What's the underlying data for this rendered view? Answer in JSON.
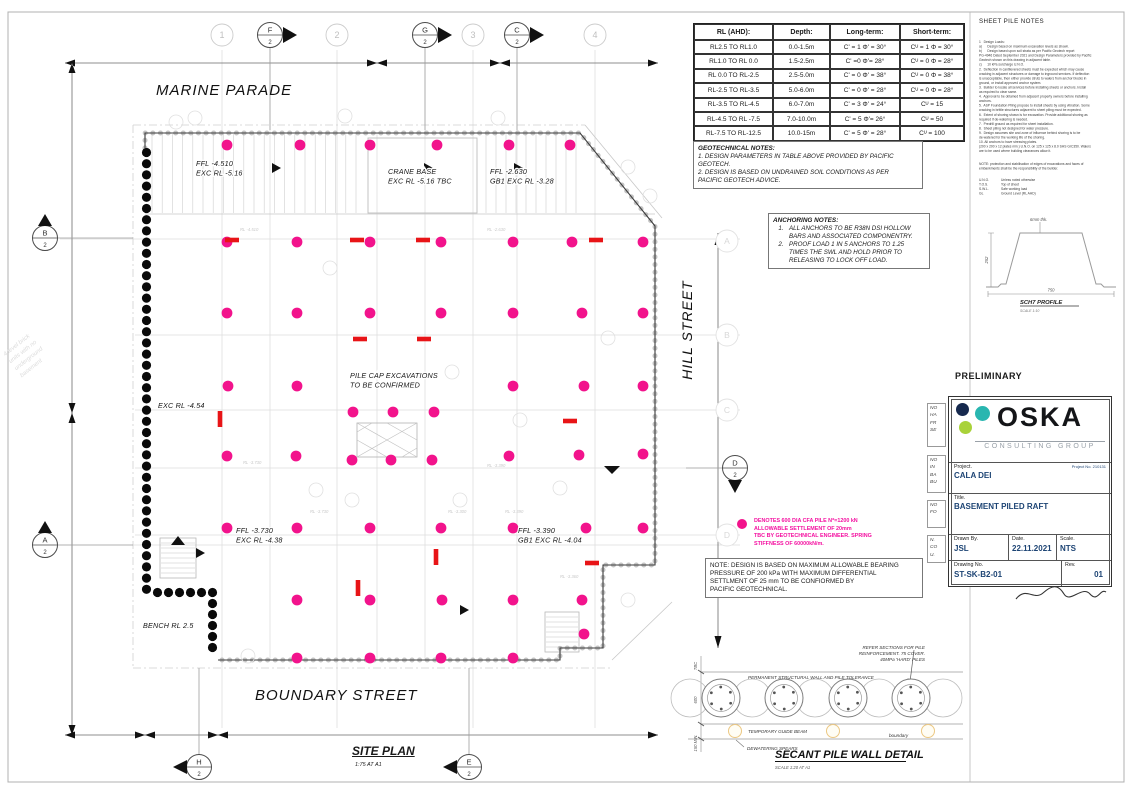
{
  "preliminary": "PRELIMINARY",
  "soil_table": {
    "headers": [
      "RL (AHD):",
      "Depth:",
      "Long-term:",
      "Short-term:"
    ],
    "rows": [
      [
        "RL2.5 TO RL1.0",
        "0.0-1.5m",
        "C' = 1 Φ' = 30°",
        "Cᵁ = 1 Φ = 30°"
      ],
      [
        "RL1.0 TO RL 0.0",
        "1.5-2.5m",
        "C' =0 Φ'= 28°",
        "Cᵁ = 0 Φ = 28°"
      ],
      [
        "RL 0.0 TO RL-2.5",
        "2.5-5.0m",
        "C' = 0 Φ' = 38°",
        "Cᵁ = 0 Φ = 38°"
      ],
      [
        "RL-2.5 TO RL-3.5",
        "5.0-6.0m",
        "C' = 0 Φ' = 28°",
        "Cᵁ = 0 Φ = 28°"
      ],
      [
        "RL-3.5 TO RL-4.5",
        "6.0-7.0m",
        "C' = 3 Φ' = 24°",
        "Cᵁ = 15"
      ],
      [
        "RL-4.5 TO RL -7.5",
        "7.0-10.0m",
        "C' = 5 Φ'= 26°",
        "Cᵁ = 50"
      ],
      [
        "RL-7.5 TO RL-12.5",
        "10.0-15m",
        "C' = 5 Φ' = 28°",
        "Cᵁ = 100"
      ]
    ]
  },
  "geotech_notes": {
    "title": "GEOTECHNICAL NOTES:",
    "lines": [
      "1. DESIGN PARAMETERS IN TABLE ABOVE PROVIDED BY PACIFIC",
      "GEOTECH.",
      "2. DESIGN IS BASED ON UNDRAINED SOIL CONDITIONS AS PER",
      "PACIFIC GEOTECH ADVICE."
    ]
  },
  "anchoring_notes": {
    "title": "ANCHORING NOTES:",
    "items": [
      {
        "num": "1.",
        "lines": [
          "ALL ANCHORS TO BE R38N DSI HOLLOW",
          "BARS AND ASSOCIATED COMPONENTRY."
        ]
      },
      {
        "num": "2.",
        "lines": [
          "PROOF LOAD 1 IN 5 ANCHORS TO 1.25",
          "TIMES THE SWL AND HOLD PRIOR TO",
          "RELEASING TO LOCK OFF LOAD."
        ]
      }
    ]
  },
  "sheet_pile_notes": {
    "title": "SHEET PILE NOTES",
    "lines": [
      "1   Design Loads:",
      "a)      Design based on maximum excavation levels as shown.",
      "b)      Design based upon soil strata as per Pacific Geotech report",
      "PG-4946 Dated September 2021 and Design Parameters provided by Pacific",
      "Geotech shown on this drawing in adjacent table.",
      "c)      10 kPa surcharge U.N.O.",
      "2.  Deflection in cantilevered sheets must be expected which may cause",
      "cracking in adjacent structures or damage to inground services. If deflection",
      "is unacceptable, then either provide struts to walers from anchor blocks in",
      "ground, or install approved anchor system.",
      "3.  Builder to locate all services before installing sheets or anchors. Install",
      "as required to clear same.",
      "4.  Approval to be obtained from adjacent property owners before installing",
      "anchors.",
      "5.  ASP Foundation Piling propose to install sheets by using vibration. Some",
      "cracking in brittle structures adjacent to sheet piling must be expected.",
      "6.  Extent of shoring shown is for excavation. Provide additional shoring as",
      "required if de-watering is needed.",
      "7.  Predrill ground as required for sheet installation.",
      "8.  Sheet piling not designed for water pressure.",
      "9.  Design assumes site and zone of influence behind shoring is to be",
      "de-watered for the working life of the shoring.",
      "10. All anchors to have stressing plates.",
      "(200 x 200 x 12 plates min.) U.N.O. on 125 x 125 x 8.0 SHS GrC350. Walers",
      "are to be used where building clearances allow it."
    ],
    "note_lines": [
      "NOTE: protection and stabilisation of edges of excavations and faces of",
      "embankments shall be the responsibility of the builder."
    ],
    "abbrevs": [
      [
        "U.N.O.",
        "Unless noted otherwise"
      ],
      [
        "T.O.S.",
        "Top of sheet"
      ],
      [
        "S.W.L.",
        "Safe working load"
      ],
      [
        "GL",
        "Ground Level (RL AHD)"
      ]
    ]
  },
  "sch7": {
    "thickness": "6mm thk.",
    "height_dim": "252",
    "width_dim": "750",
    "title": "SCH7 PROFILE",
    "subtitle": "SCALE 1:10"
  },
  "pink_legend": {
    "color": "#F2138C",
    "lines": [
      "DENOTES 600 DIA CFA PILE N*=1200 kN",
      "ALLOWABLE SETTLEMENT OF 20mm",
      "TBC BY GEOTECHNICAL ENGINEER. SPRING",
      "STIFFNESS OF 60000kN/m."
    ]
  },
  "bearing_note": [
    "NOTE: DESIGN IS BASED ON MAXIMUM ALLOWABLE BEARING",
    "PRESSURE OF 200 kPa WITH MAXIMUM DIFFERENTIAL",
    "SETTLMENT OF 25 mm TO BE CONFIORMED BY",
    "PACIFIC GEOTECHNICAL."
  ],
  "title_block": {
    "project_no": "Project No. 210131",
    "logo": {
      "word": "OSKA",
      "sub": "CONSULTING GROUP",
      "dot_colors": [
        "#16294E",
        "#29B6B0",
        "#A9D23A"
      ]
    },
    "project_label": "Project.",
    "project": "CALA DEI",
    "title_label": "Title.",
    "title": "BASEMENT PILED RAFT",
    "drawn_label": "Drawn By.",
    "drawn": "JSL",
    "date_label": "Date.",
    "date": "22.11.2021",
    "scale_label": "Scale.",
    "scale": "NTS",
    "dwg_label": "Drawing No.",
    "dwg": "ST-SK-B2-01",
    "rev_label": "Rev.",
    "rev": "01"
  },
  "clipped_notes": [
    [
      "NO",
      "HA",
      "FR",
      "SE"
    ],
    [
      "NO",
      "IN",
      "BA",
      "BU"
    ],
    [
      "NO",
      "FO"
    ],
    [
      "N.",
      "CO",
      "U."
    ]
  ],
  "plan": {
    "street_top": "MARINE PARADE",
    "street_right": "HILL STREET",
    "street_bottom": "BOUNDARY STREET",
    "site_title": "SITE PLAN",
    "site_scale": "1:75 AT A1",
    "ghost_lines": [
      "4 level brick",
      "units with no",
      "underground",
      "basement"
    ],
    "labels": [
      {
        "x": 196,
        "y": 166,
        "lines": [
          "FFL -4.510",
          "EXC RL -5.16"
        ]
      },
      {
        "x": 388,
        "y": 174,
        "lines": [
          "CRANE BASE",
          "EXC RL -5.16 TBC"
        ]
      },
      {
        "x": 490,
        "y": 174,
        "lines": [
          "FFL -2.630",
          "GB1 EXC RL -3.28"
        ]
      },
      {
        "x": 350,
        "y": 378,
        "lines": [
          "PILE CAP EXCAVATIONS",
          "TO BE CONFIRMED"
        ]
      },
      {
        "x": 158,
        "y": 408,
        "lines": [
          "EXC RL -4.54"
        ]
      },
      {
        "x": 236,
        "y": 533,
        "lines": [
          "FFL -3.730",
          "EXC RL -4.38"
        ]
      },
      {
        "x": 518,
        "y": 533,
        "lines": [
          "FFL -3.390",
          "GB1 EXC RL -4.04"
        ]
      },
      {
        "x": 143,
        "y": 628,
        "lines": [
          "BENCH RL 2.5"
        ]
      }
    ],
    "faint_labels": [
      {
        "x": 240,
        "y": 231,
        "t": "RL -4.510"
      },
      {
        "x": 487,
        "y": 231,
        "t": "RL -2.630"
      },
      {
        "x": 243,
        "y": 464,
        "t": "RL -3.730"
      },
      {
        "x": 310,
        "y": 513,
        "t": "RL -3.730"
      },
      {
        "x": 487,
        "y": 467,
        "t": "RL -3.390"
      },
      {
        "x": 505,
        "y": 513,
        "t": "RL -3.390"
      },
      {
        "x": 448,
        "y": 513,
        "t": "RL -3.300"
      },
      {
        "x": 560,
        "y": 578,
        "t": "RL -3.360"
      }
    ],
    "grid": {
      "top": [
        {
          "label": "1",
          "x": 222,
          "type": "grid"
        },
        {
          "label": "F",
          "sub": "2",
          "x": 270,
          "type": "section"
        },
        {
          "label": "2",
          "x": 337,
          "type": "grid"
        },
        {
          "label": "G",
          "sub": "2",
          "x": 425,
          "type": "section"
        },
        {
          "label": "3",
          "x": 473,
          "type": "grid"
        },
        {
          "label": "C",
          "sub": "2",
          "x": 517,
          "type": "section"
        },
        {
          "label": "4",
          "x": 595,
          "type": "grid"
        }
      ],
      "left": [
        {
          "label": "B",
          "sub": "2",
          "y": 238
        },
        {
          "label": "A",
          "sub": "2",
          "y": 545
        }
      ],
      "right": [
        {
          "label": "A",
          "y": 241,
          "type": "faint"
        },
        {
          "label": "B",
          "y": 335,
          "type": "faint"
        },
        {
          "label": "C",
          "y": 410,
          "type": "faint"
        },
        {
          "label": "D",
          "sub": "2",
          "y": 468,
          "type": "section"
        },
        {
          "label": "D",
          "y": 535,
          "type": "faint"
        }
      ],
      "bottom": [
        {
          "label": "H",
          "sub": "2",
          "x": 199
        },
        {
          "label": "E",
          "sub": "2",
          "x": 469
        }
      ]
    }
  },
  "piles": {
    "color": "#F2138C",
    "points": [
      [
        227,
        145
      ],
      [
        300,
        145
      ],
      [
        370,
        145
      ],
      [
        437,
        145
      ],
      [
        509,
        145
      ],
      [
        570,
        145
      ],
      [
        227,
        242
      ],
      [
        297,
        242
      ],
      [
        370,
        242
      ],
      [
        441,
        242
      ],
      [
        513,
        242
      ],
      [
        572,
        242
      ],
      [
        643,
        242
      ],
      [
        227,
        313
      ],
      [
        297,
        313
      ],
      [
        370,
        313
      ],
      [
        441,
        313
      ],
      [
        513,
        313
      ],
      [
        582,
        313
      ],
      [
        643,
        313
      ],
      [
        228,
        386
      ],
      [
        297,
        386
      ],
      [
        513,
        386
      ],
      [
        584,
        386
      ],
      [
        643,
        386
      ],
      [
        353,
        412
      ],
      [
        393,
        412
      ],
      [
        434,
        412
      ],
      [
        227,
        456
      ],
      [
        296,
        456
      ],
      [
        352,
        460
      ],
      [
        391,
        460
      ],
      [
        432,
        460
      ],
      [
        509,
        456
      ],
      [
        579,
        455
      ],
      [
        643,
        454
      ],
      [
        227,
        528
      ],
      [
        297,
        528
      ],
      [
        370,
        528
      ],
      [
        441,
        528
      ],
      [
        513,
        528
      ],
      [
        586,
        528
      ],
      [
        643,
        528
      ],
      [
        297,
        600
      ],
      [
        370,
        600
      ],
      [
        442,
        600
      ],
      [
        513,
        600
      ],
      [
        582,
        600
      ],
      [
        584,
        634
      ],
      [
        297,
        658
      ],
      [
        370,
        658
      ],
      [
        441,
        658
      ],
      [
        513,
        658
      ]
    ]
  },
  "anchors": {
    "color": "#E81417",
    "h": [
      [
        232,
        240
      ],
      [
        357,
        240
      ],
      [
        423,
        240
      ],
      [
        596,
        240
      ],
      [
        360,
        339
      ],
      [
        424,
        339
      ],
      [
        570,
        421
      ],
      [
        592,
        563
      ]
    ],
    "v": [
      [
        220,
        419
      ],
      [
        436,
        557
      ],
      [
        358,
        588
      ]
    ]
  },
  "secant_detail": {
    "refer_lines": [
      "REFER SECTIONS FOR PILE",
      "REINFORCEMENT. 75 COVER.",
      "40MPa 'HARD' PILES"
    ],
    "perm": "PERMANENT STRUCTURAL WALL AND PILE TOLERANCE",
    "guide": "TEMPORARY GUIDE BEAM",
    "boundary": "boundary",
    "spears": "DEWATERING SPEARS",
    "title": "SECANT PILE WALL DETAIL",
    "scale": "SCALE 1:20 AT A1",
    "dims": [
      "TBC",
      "600",
      "150 MIN."
    ]
  }
}
